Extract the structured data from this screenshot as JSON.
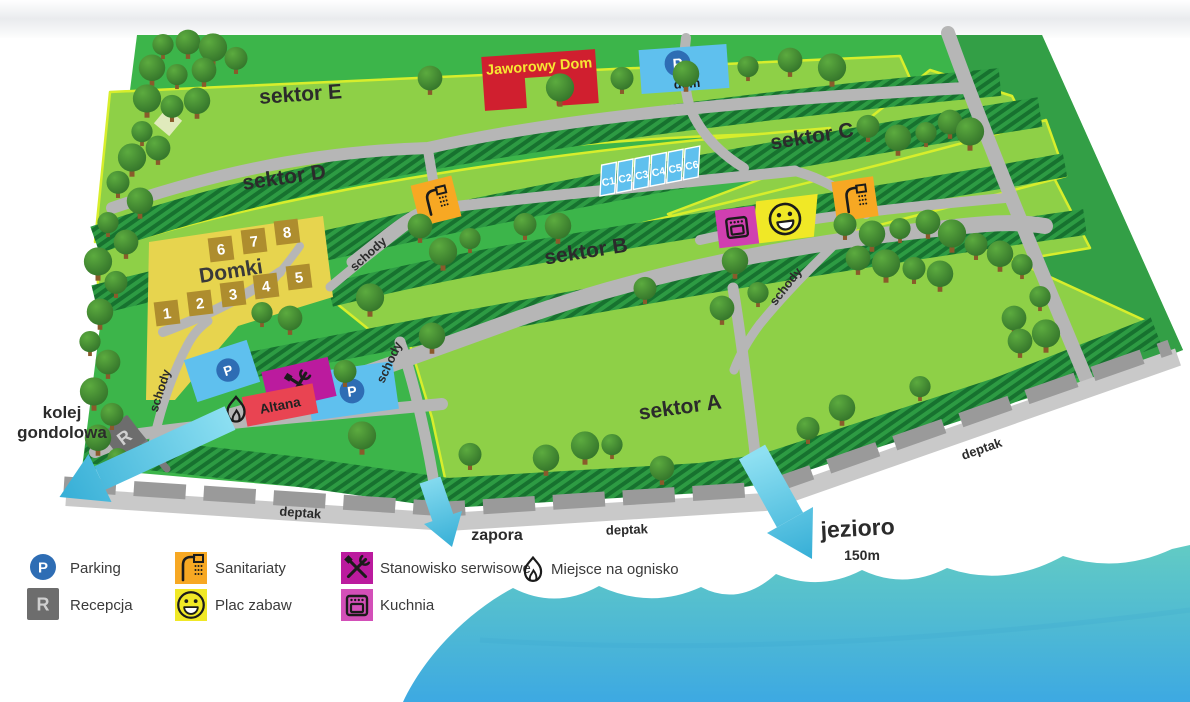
{
  "map": {
    "sectors": [
      {
        "label": "sektor E"
      },
      {
        "label": "sektor D"
      },
      {
        "label": "sektor C"
      },
      {
        "label": "sektor B"
      },
      {
        "label": "sektor A"
      }
    ],
    "jaworowy_dom": "Jaworowy Dom",
    "parking_symbol": "P",
    "reception_symbol": "R",
    "parking_dom_label": "dom",
    "domki": {
      "title": "Domki",
      "cabins": [
        "1",
        "2",
        "3",
        "4",
        "5",
        "6",
        "7",
        "8"
      ]
    },
    "pitches": [
      "C1",
      "C2",
      "C3",
      "C4",
      "C5",
      "C6"
    ],
    "altana": "Altana",
    "schody": "schody",
    "deptak": "deptak",
    "kolej_line1": "kolej",
    "kolej_line2": "gondolowa",
    "zapora": "zapora",
    "jezioro": "jezioro",
    "jezioro_distance": "150m"
  },
  "legend": {
    "items": [
      {
        "icon": "parking-icon",
        "label": "Parking"
      },
      {
        "icon": "reception-icon",
        "label": "Recepcja"
      },
      {
        "icon": "sanitary-icon",
        "label": "Sanitariaty"
      },
      {
        "icon": "playground-icon",
        "label": "Plac zabaw"
      },
      {
        "icon": "service-icon",
        "label": "Stanowisko serwisowe"
      },
      {
        "icon": "kitchen-icon",
        "label": "Kuchnia"
      },
      {
        "icon": "campfire-icon",
        "label": "Miejsce na ognisko"
      }
    ]
  },
  "colors": {
    "map_green": "#3cb54a",
    "map_green_dark": "#339f46",
    "sector_green": "#8ed047",
    "sector_border": "#d7ee2c",
    "hatch_base": "#2d9b43",
    "hatch_stripe": "#17722f",
    "road_gray": "#b6b6b6",
    "deptak_band": "#c9c9c9",
    "deptak_dash": "#9a9a9a",
    "water_top": "#62cbc4",
    "water_bottom": "#3da9e2",
    "arrow_cyan": "#4fc0e0",
    "building_red": "#d01f2f",
    "building_text_yellow": "#f7e733",
    "parking_blue": "#5fc0ee",
    "parking_circle_blue": "#2e6db4",
    "domki_yellow": "#e7d44e",
    "cabin_brown": "#ae8d2e",
    "sanitary_orange": "#f7a823",
    "playground_yellow": "#f0e826",
    "service_magenta": "#bb1b9e",
    "kitchen_pink": "#d03fb0",
    "reception_gray": "#6d6d6d",
    "altana_red": "#e94452"
  }
}
